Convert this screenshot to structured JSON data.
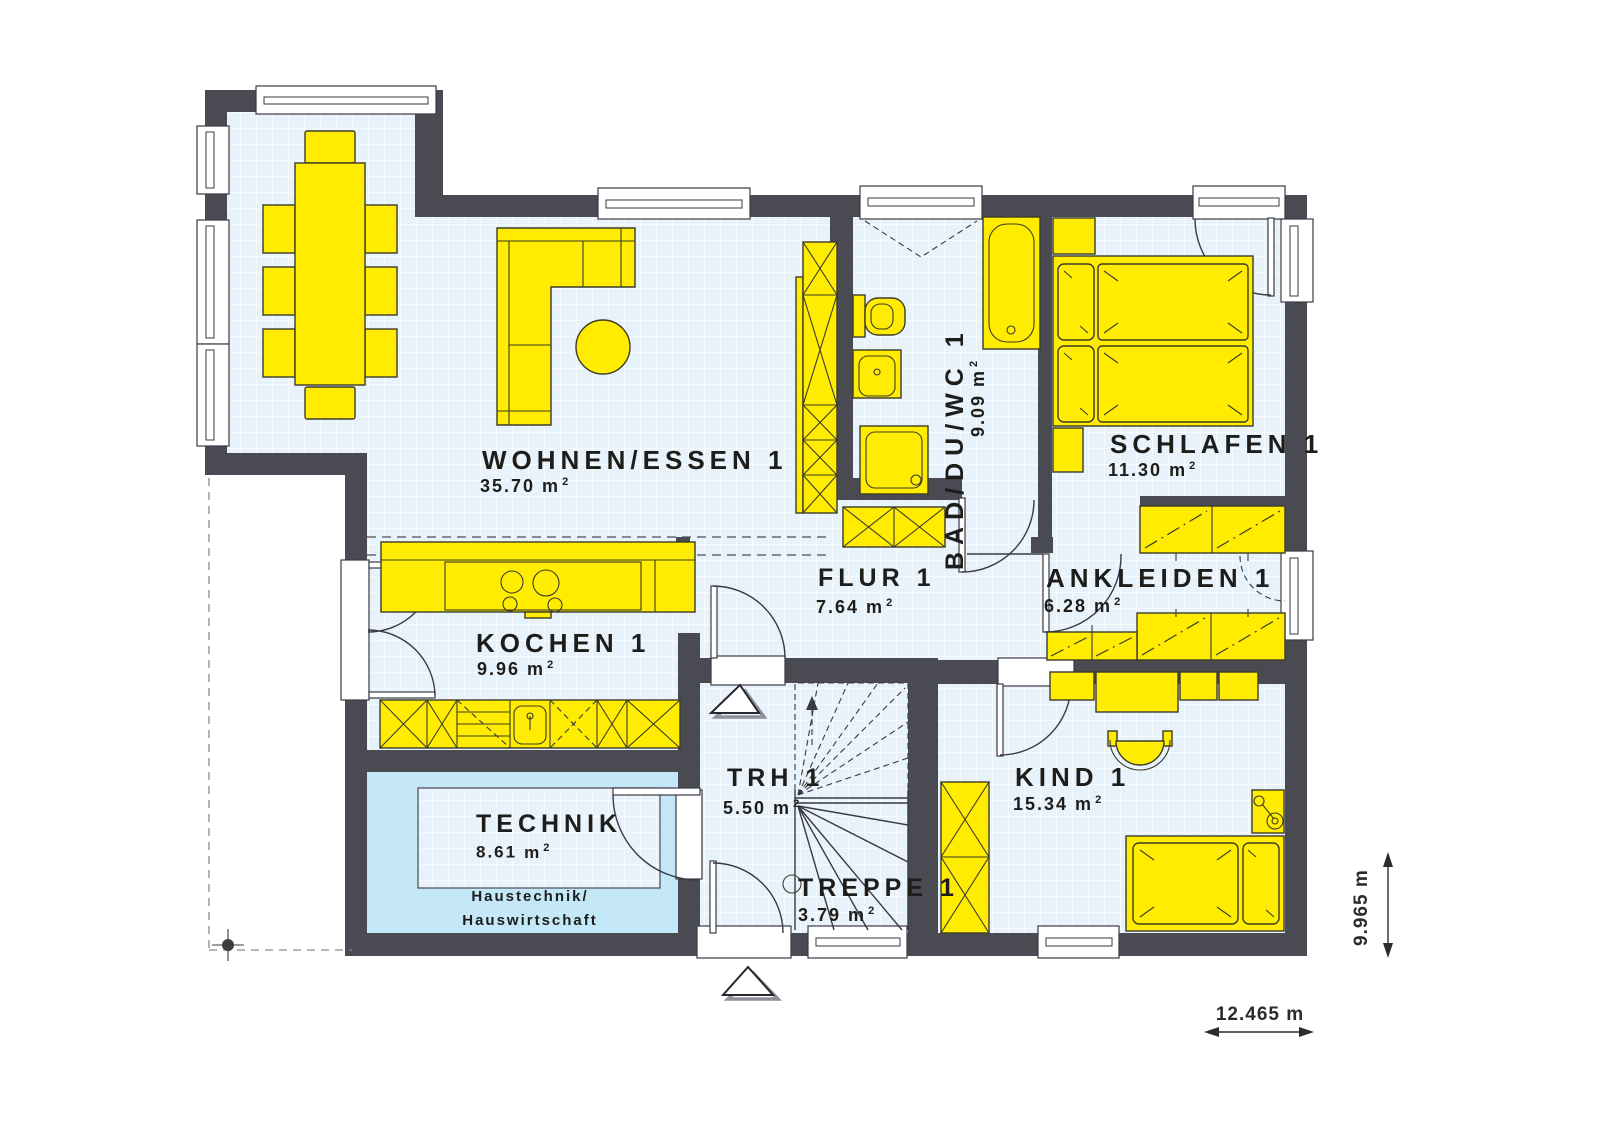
{
  "plan": {
    "rooms": [
      {
        "id": "wohnen-essen",
        "name": "WOHNEN/ESSEN 1",
        "area": "35.70"
      },
      {
        "id": "kochen",
        "name": "KOCHEN 1",
        "area": "9.96"
      },
      {
        "id": "technik",
        "name": "TECHNIK",
        "area": "8.61",
        "note_line1": "Haustechnik/",
        "note_line2": "Hauswirtschaft"
      },
      {
        "id": "trh",
        "name": "TRH 1",
        "area": "5.50"
      },
      {
        "id": "treppe",
        "name": "TREPPE 1",
        "area": "3.79"
      },
      {
        "id": "flur",
        "name": "FLUR 1",
        "area": "7.64"
      },
      {
        "id": "bad-du-wc",
        "name": "BAD/DU/WC 1",
        "area": "9.09"
      },
      {
        "id": "schlafen",
        "name": "SCHLAFEN 1",
        "area": "11.30"
      },
      {
        "id": "ankleiden",
        "name": "ANKLEIDEN 1",
        "area": "6.28"
      },
      {
        "id": "kind",
        "name": "KIND 1",
        "area": "15.34"
      }
    ],
    "units": {
      "sqm": "m",
      "sup": "2"
    },
    "dimensions": {
      "width": "12.465 m",
      "height": "9.965 m"
    },
    "colors": {
      "wall": "#4a4a52",
      "floor": "#e8f2fb",
      "grid": "#ffffff",
      "furniture": "#ffec00",
      "technik": "#c5e8f8",
      "line": "#3a3a42",
      "text": "#1d1d1b"
    }
  }
}
